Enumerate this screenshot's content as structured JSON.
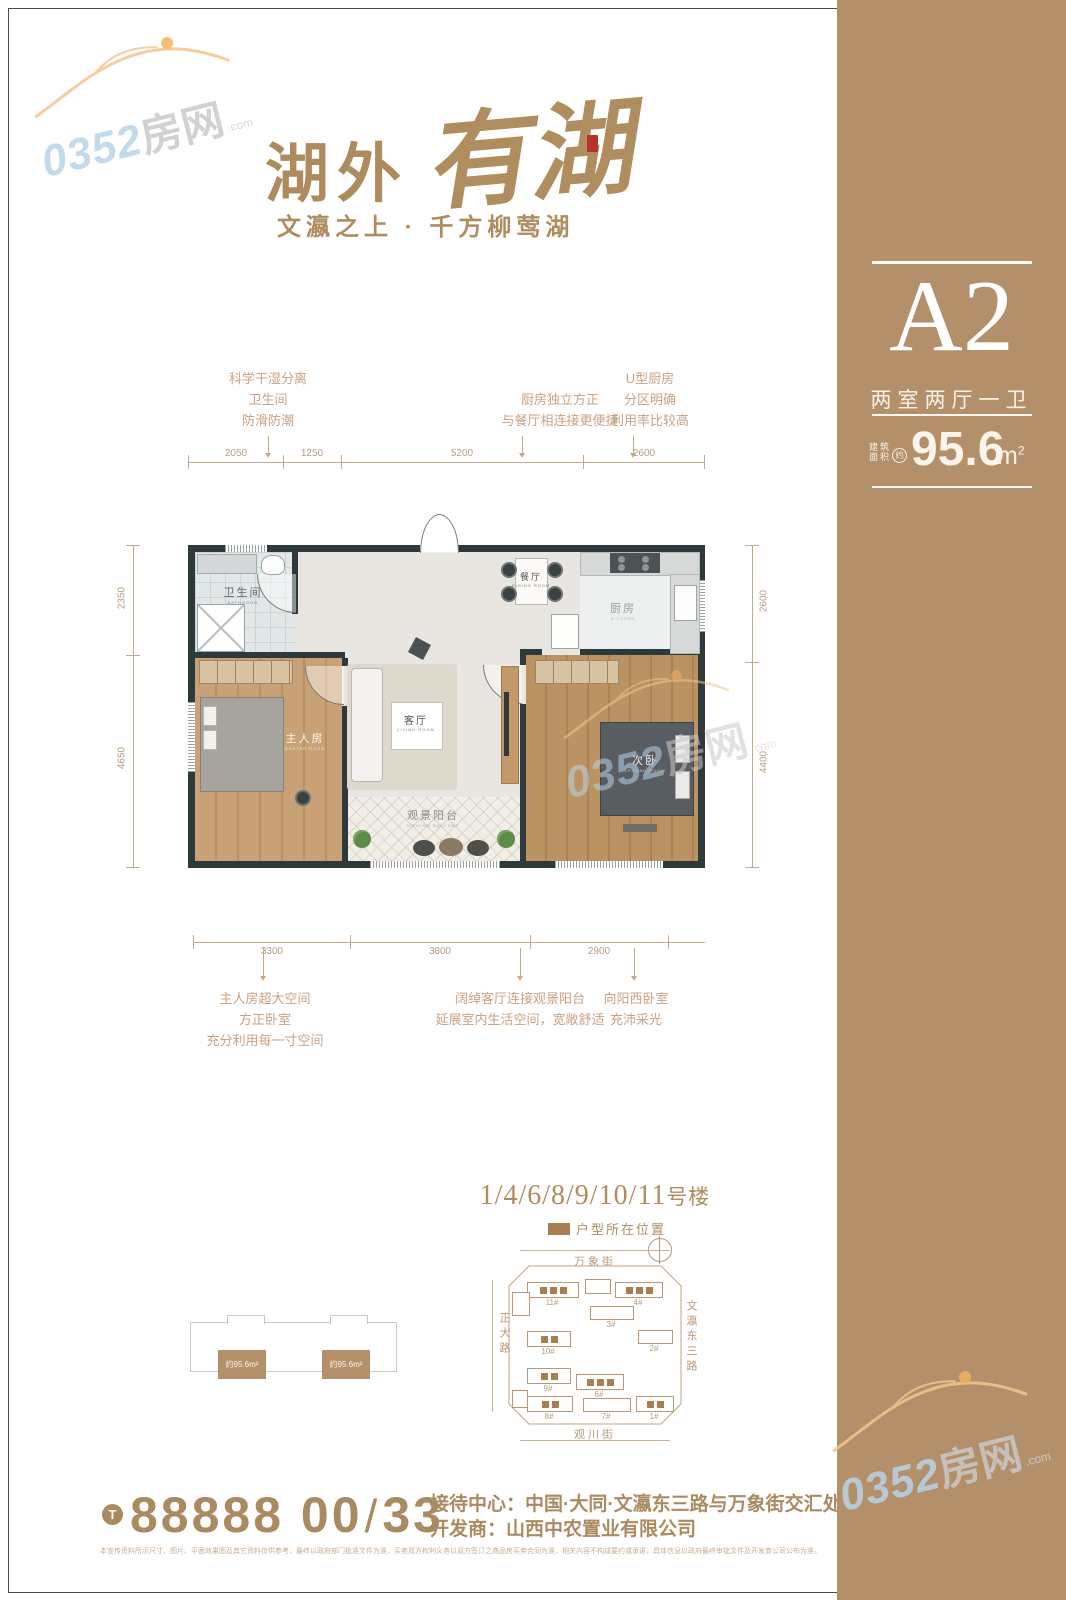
{
  "logo": {
    "prefix": "湖外",
    "script": "有湖",
    "tagline": "文瀛之上 · 千方柳莺湖"
  },
  "sidebar": {
    "unit": "A2",
    "layout": "两室两厅一卫",
    "area_label_1": "建筑",
    "area_label_2": "面积",
    "area_approx": "约",
    "area_value": "95.6",
    "area_unit": "m",
    "area_sup": "2"
  },
  "plan": {
    "callouts_top": [
      {
        "lines": [
          "科学干湿分离",
          "卫生间",
          "防滑防潮"
        ]
      },
      {
        "lines": [
          "厨房独立方正",
          "与餐厅相连接更便捷"
        ]
      },
      {
        "lines": [
          "U型厨房",
          "分区明确",
          "利用率比较高"
        ]
      }
    ],
    "callouts_bottom": [
      {
        "lines": [
          "主人房超大空间",
          "方正卧室",
          "充分利用每一寸空间"
        ]
      },
      {
        "lines": [
          "阔绰客厅连接观景阳台",
          "延展室内生活空间，宽敞舒适"
        ]
      },
      {
        "lines": [
          "向阳西卧室",
          "充沛采光"
        ]
      }
    ],
    "dims_top": [
      "2050",
      "1250",
      "5200",
      "2600"
    ],
    "dims_bottom": [
      "3300",
      "3800",
      "2900"
    ],
    "dims_left": [
      "2350",
      "4650"
    ],
    "dims_right": [
      "2600",
      "4400"
    ],
    "rooms": {
      "bath": {
        "name": "卫生间",
        "sub": "BATHROOM"
      },
      "master": {
        "name": "主人房",
        "sub": "MASTER ROOM"
      },
      "living": {
        "name": "客厅",
        "sub": "LIVING ROOM"
      },
      "dining": {
        "name": "餐厅",
        "sub": "DINING ROOM"
      },
      "kitchen": {
        "name": "厨房",
        "sub": "KITCHEN"
      },
      "balcony": {
        "name": "观景阳台",
        "sub": "VIEWING BALCONY"
      },
      "second": {
        "name": "次卧",
        "sub": "SECOND ROOM"
      }
    }
  },
  "location": {
    "title_nums": "1/4/6/8/9/10/11",
    "title_suffix": "号楼",
    "legend": "户型所在位置",
    "streets": {
      "top": "万象街",
      "left": "正大路",
      "right": "文瀛东三路",
      "bottom": "观川街"
    },
    "buildings": [
      {
        "label": "11#"
      },
      {
        "label": "4#"
      },
      {
        "label": "3#"
      },
      {
        "label": "2#"
      },
      {
        "label": "10#"
      },
      {
        "label": "9#"
      },
      {
        "label": "6#"
      },
      {
        "label": "8#"
      },
      {
        "label": "7#"
      },
      {
        "label": "1#"
      }
    ],
    "sketch_units": [
      "约95.6m²",
      "约95.6m²"
    ]
  },
  "footer": {
    "phone_icon": "T",
    "phone_number": "88888 00",
    "phone_slash": "/",
    "phone_ext": "33",
    "reception_label": "接待中心：",
    "reception": "中国·大同·文瀛东三路与万象街交汇处",
    "developer_label": "开发商：",
    "developer": "山西中农置业有限公司",
    "disclaimer": "本宣传资料所示尺寸、图片、平面效果图及其它资料仅供参考，最终以政府部门批准文件为准，买卖双方权利义务以双方签订之商品房买卖合同为准，相关内容不构成要约或承诺，具体信息以政府最终审批文件及开发商公司公布为准。"
  },
  "watermark": {
    "num": "0352",
    "name": "房网",
    "dom": ".com"
  }
}
